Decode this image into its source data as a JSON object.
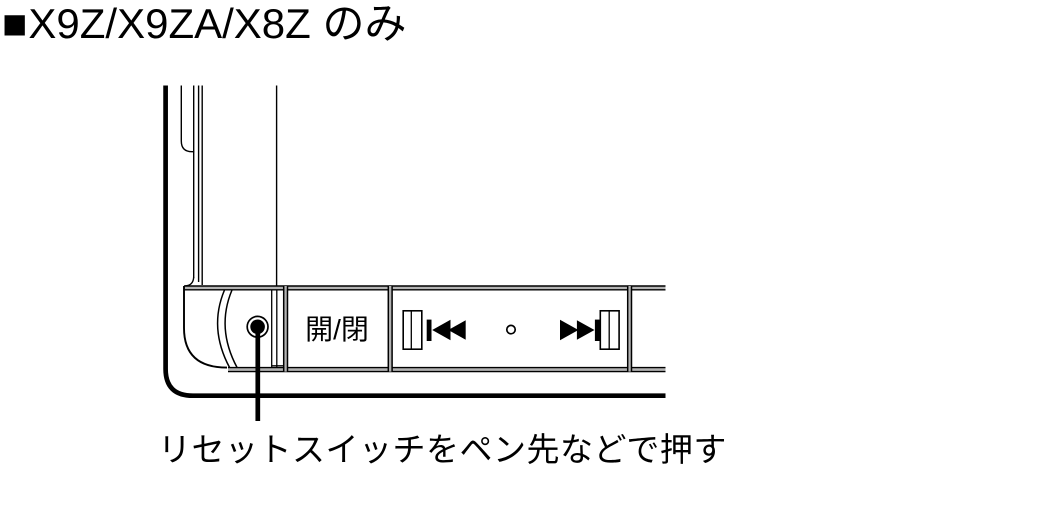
{
  "title": {
    "marker": "■",
    "text": "X9Z/X9ZA/X8Z のみ"
  },
  "diagram": {
    "caption": "リセットスイッチをペン先などで押す",
    "eject_button": {
      "label": "開/閉"
    },
    "icons": [
      {
        "name": "previous-track-icon",
        "glyph": "⏮"
      },
      {
        "name": "indicator-hole-icon",
        "glyph": "○"
      },
      {
        "name": "next-track-icon",
        "glyph": "⏭"
      },
      {
        "name": "reset-switch",
        "glyph": "●"
      }
    ],
    "colors": {
      "line": "#000000",
      "shade": "#b3b3b3",
      "background": "#ffffff"
    }
  }
}
